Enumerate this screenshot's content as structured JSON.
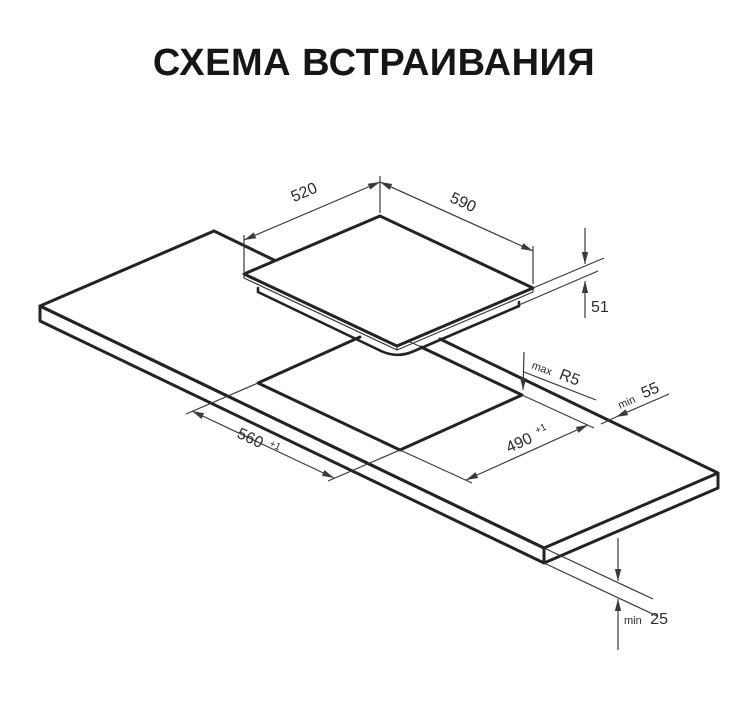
{
  "title": "СХЕМА ВСТРАИВАНИЯ",
  "diagram": {
    "description": "isometric built-in installation drawing of a cooktop above a countertop cutout",
    "colors": {
      "background": "#ffffff",
      "line_bold": "#232323",
      "line_thin": "#3a3a3a",
      "title_text": "#161616"
    },
    "dimensions": {
      "cooktop_width": {
        "value": "520"
      },
      "cooktop_length": {
        "value": "590"
      },
      "cooktop_height": {
        "value": "51"
      },
      "cutout_corner_radius": {
        "prefix": "max",
        "value": "R5"
      },
      "rear_clearance": {
        "prefix": "min",
        "value": "55"
      },
      "cutout_width": {
        "value": "490",
        "tolerance": "+1"
      },
      "cutout_length": {
        "value": "560",
        "tolerance": "+1"
      },
      "countertop_thickness": {
        "prefix": "min",
        "value": "25"
      }
    }
  }
}
